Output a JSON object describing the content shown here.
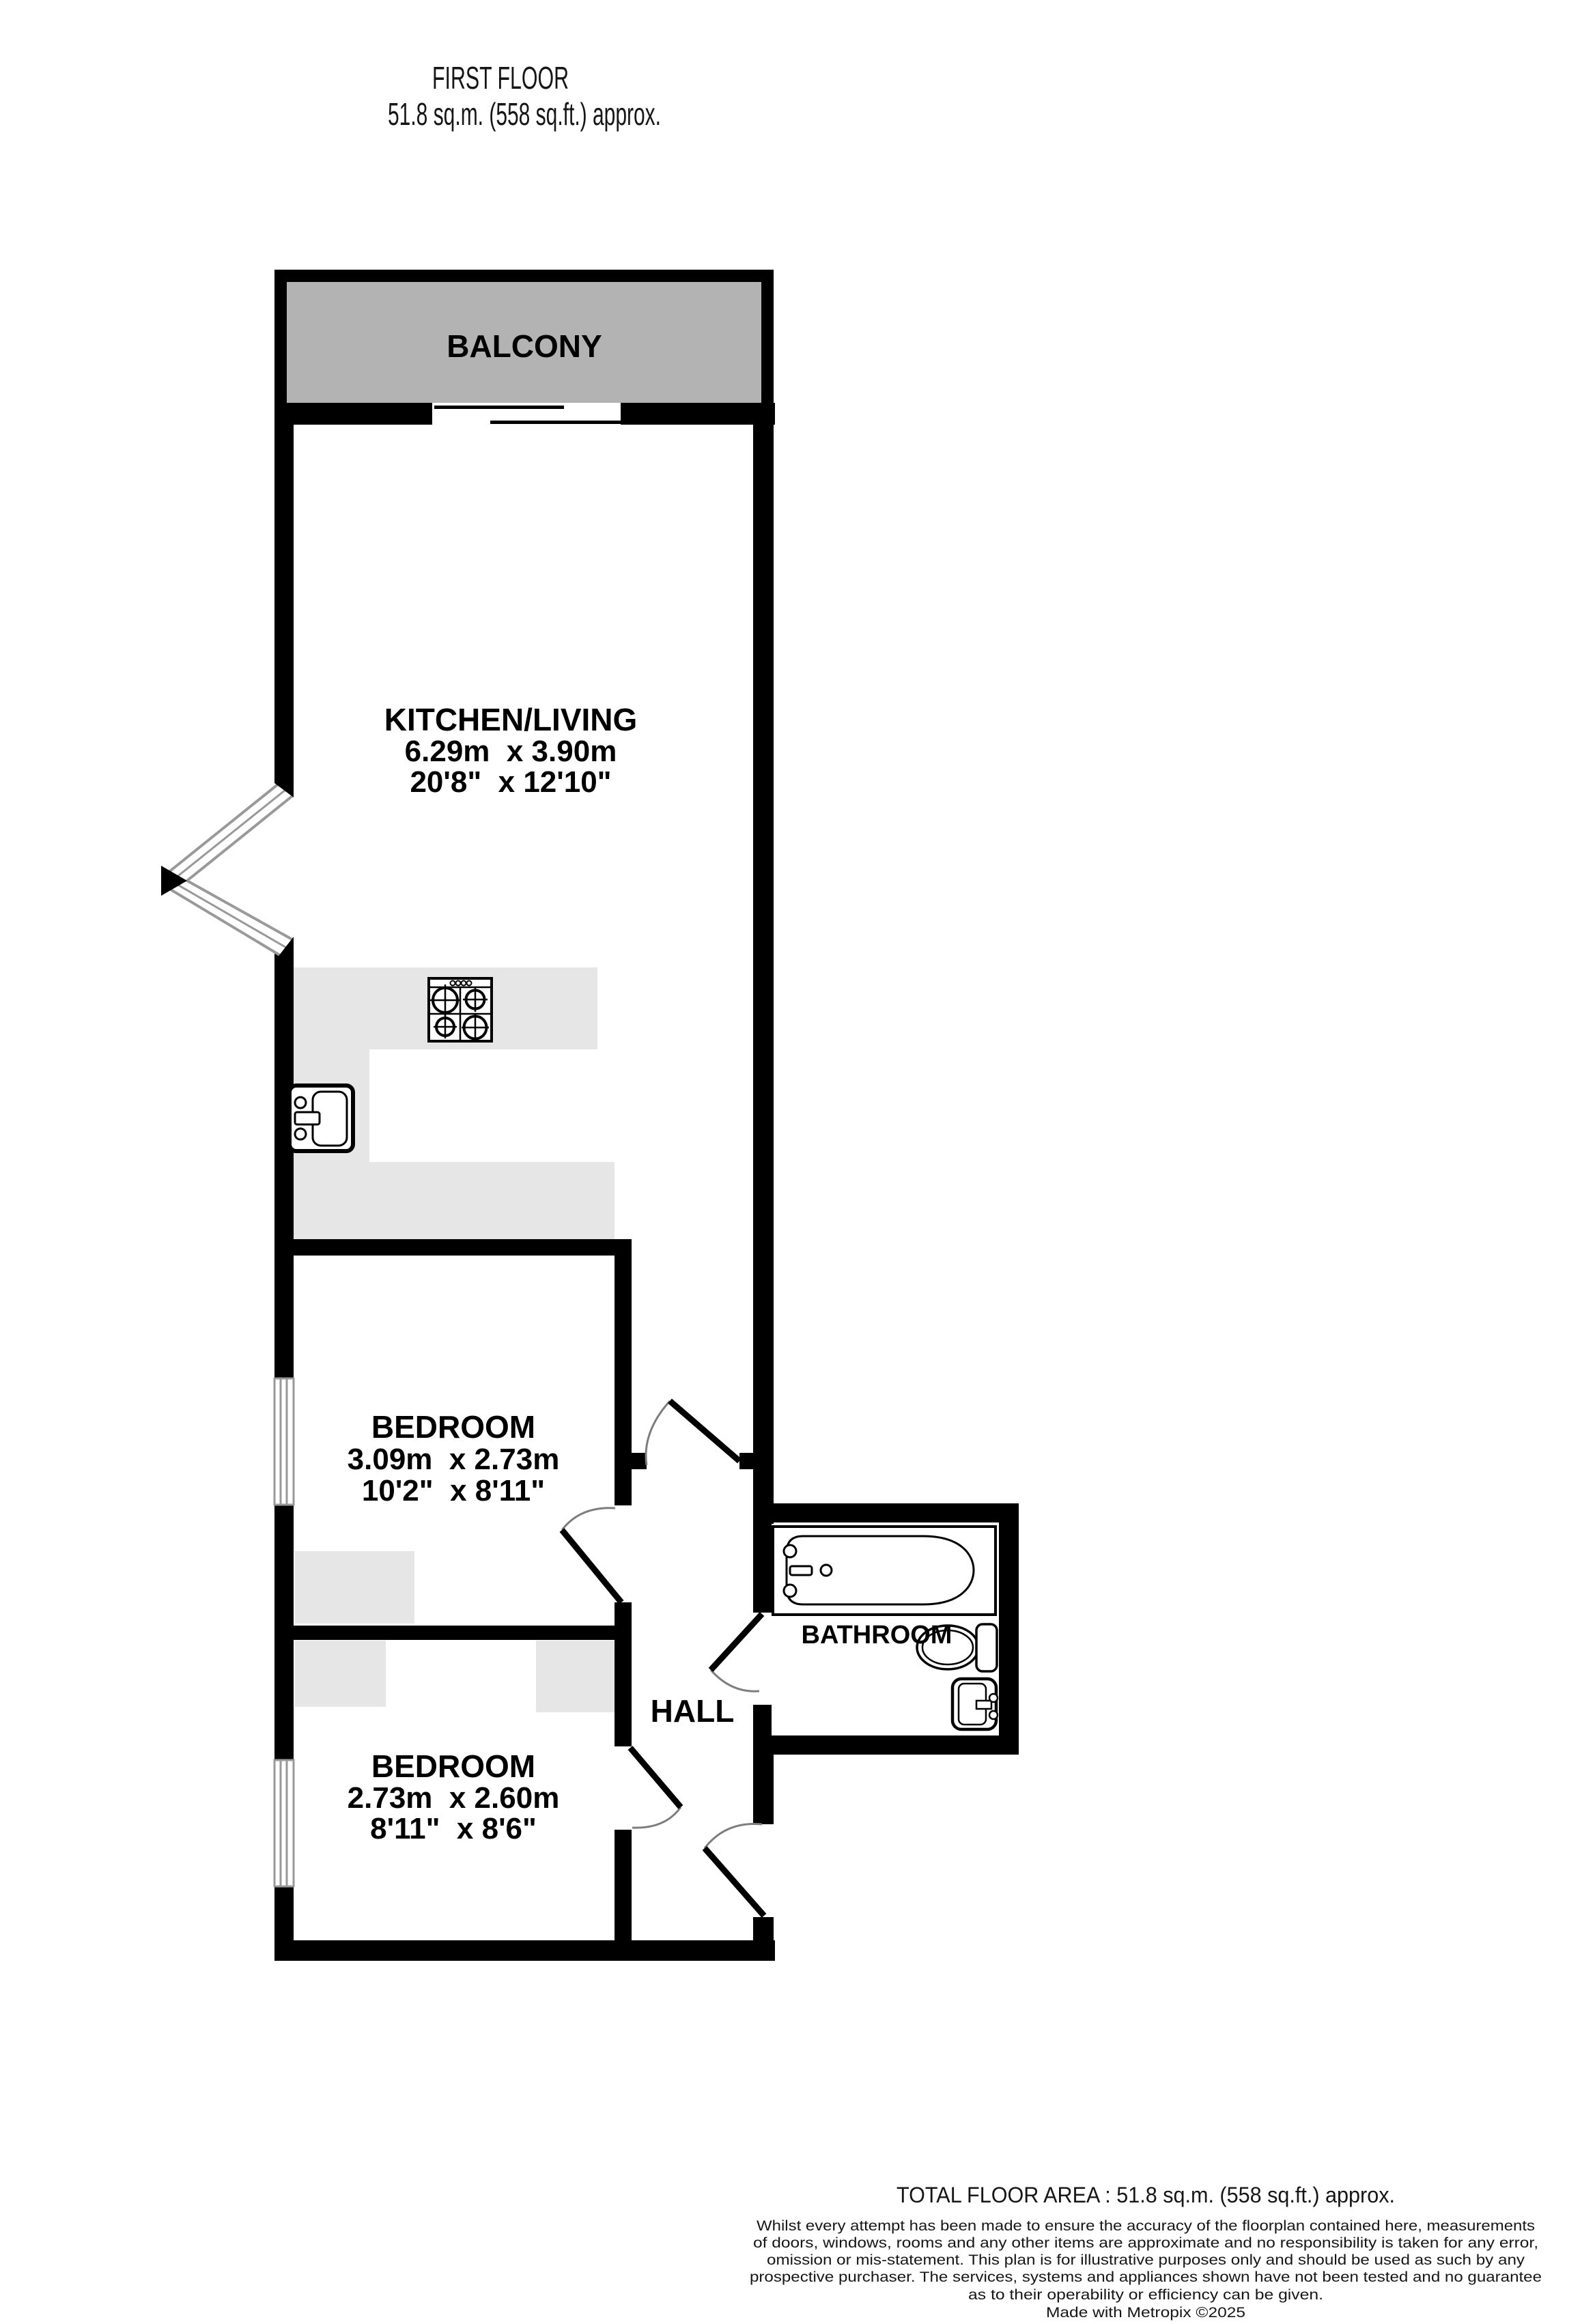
{
  "title": {
    "line1": "FIRST FLOOR",
    "line2": "51.8 sq.m. (558 sq.ft.) approx."
  },
  "rooms": {
    "balcony": {
      "label": "BALCONY"
    },
    "kitchen_living": {
      "label": "KITCHEN/LIVING",
      "metric": "6.29m  x 3.90m",
      "imperial": "20'8\"  x 12'10\""
    },
    "bedroom_1": {
      "label": "BEDROOM",
      "metric": "3.09m  x 2.73m",
      "imperial": "10'2\"  x 8'11\""
    },
    "bedroom_2": {
      "label": "BEDROOM",
      "metric": "2.73m  x 2.60m",
      "imperial": "8'11\"  x 8'6\""
    },
    "hall": {
      "label": "HALL"
    },
    "bathroom": {
      "label": "BATHROOM"
    }
  },
  "fixtures": [
    "stove",
    "kitchen-sink",
    "bathtub",
    "toilet",
    "wash-basin"
  ],
  "footer": {
    "total_area": "TOTAL FLOOR AREA : 51.8 sq.m. (558 sq.ft.) approx.",
    "disclaimer_lines": [
      "Whilst every attempt has been made to ensure the accuracy of the floorplan contained here, measurements",
      "of doors, windows, rooms and any other items are approximate and no responsibility is taken for any error,",
      "omission or mis-statement. This plan is for illustrative purposes only and should be used as such by any",
      "prospective purchaser. The services, systems and appliances shown have not been tested and no guarantee",
      "as to their operability or efficiency can be given."
    ],
    "credit": "Made with Metropix ©2025"
  },
  "colors": {
    "wall": "#000000",
    "balcony_fill": "#b3b3b3",
    "furniture_fill": "#e6e6e6",
    "window_frame": "#999999",
    "door_arc": "#7d7d7d"
  }
}
